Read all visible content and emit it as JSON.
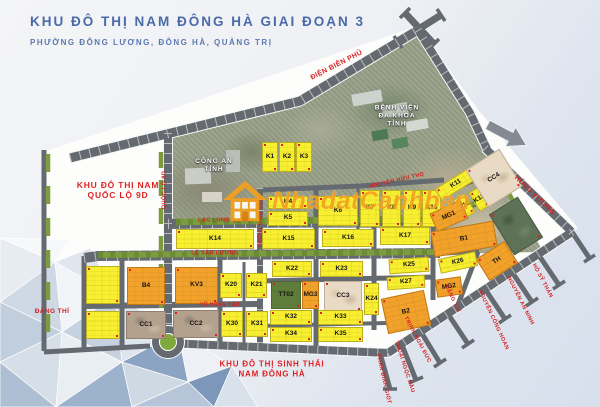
{
  "header": {
    "title": "KHU ĐÔ THỊ NAM ĐÔNG HÀ GIAI ĐOẠN 3",
    "subtitle": "PHƯỜNG ĐÔNG LƯƠNG, ĐÔNG HÀ, QUẢNG TRỊ"
  },
  "watermark": {
    "text": "NhadatCanhban"
  },
  "adjacent_areas": {
    "nam_ql9d": {
      "line1": "KHU ĐÔ THỊ NAM",
      "line2": "QUỐC LỘ 9D"
    },
    "sinh_thai": {
      "line1": "KHU ĐÔ THỊ SINH THÁI",
      "line2": "NAM ĐÔNG HÀ"
    }
  },
  "landmarks": {
    "cong_an": {
      "line1": "CÔNG AN",
      "line2": "TỈNH"
    },
    "benh_vien": {
      "line1": "BỆNH VIỆN",
      "line2": "ĐA KHOA",
      "line3": "TỈNH"
    }
  },
  "streets": {
    "dien_bien_phu": "ĐIỆN BIÊN PHỦ",
    "hung_vuong": "HÙNG VƯƠNG",
    "quoc_lo_9d": "QUỐC LỘ 9D",
    "lac_long_quan": "LẠC LONG QUÂN",
    "le_van_luong": "LÊ VĂN LƯƠNG",
    "tran_binh_trong": "TRẦN BÌNH TRỌNG",
    "nguyen_huu_tho": "NGUYỄN HỮU THỌ",
    "vu_hong_tan": "VŨ HỒNG TẤN",
    "dang_thi": "ĐẶNG THÍ",
    "phan_dinh_giot": "PHAN ĐÌNH GIÓT",
    "thoai_ngoc_hau": "THOẠI NGỌC HẦU",
    "trinh_hoai_duc": "TRỊNH HOÀI ĐỨC",
    "nguyen_cong_hoan": "NGUYỄN CÔNG HOAN",
    "nguyen_an_ninh": "NGUYỄN AN NINH",
    "ho_sy_than": "HỒ SỸ THẢN"
  },
  "blocks": {
    "k1": {
      "label": "K1"
    },
    "k2": {
      "label": "K2"
    },
    "k3": {
      "label": "K3"
    },
    "k4": {
      "label": "K4"
    },
    "k5": {
      "label": "K5"
    },
    "k6": {
      "label": "K6"
    },
    "k7": {
      "label": "K7"
    },
    "k8": {
      "label": "K8"
    },
    "k9": {
      "label": "K9"
    },
    "k10": {
      "label": "K10"
    },
    "k11": {
      "label": "K11"
    },
    "k12": {
      "label": "K12"
    },
    "k13": {
      "label": "K13"
    },
    "k14": {
      "label": "K14"
    },
    "k15": {
      "label": "K15"
    },
    "k16": {
      "label": "K16"
    },
    "k17": {
      "label": "K17"
    },
    "k20": {
      "label": "K20"
    },
    "k21": {
      "label": "K21"
    },
    "k22": {
      "label": "K22"
    },
    "k23": {
      "label": "K23"
    },
    "k24": {
      "label": "K24"
    },
    "k25": {
      "label": "K25"
    },
    "k26": {
      "label": "K26"
    },
    "k27": {
      "label": "K27"
    },
    "k30": {
      "label": "K30"
    },
    "k31": {
      "label": "K31"
    },
    "k32": {
      "label": "K32"
    },
    "k33": {
      "label": "K33"
    },
    "k34": {
      "label": "K34"
    },
    "k35": {
      "label": "K35"
    },
    "b1": {
      "label": "B1"
    },
    "b2": {
      "label": "B2"
    },
    "b4": {
      "label": "B4"
    },
    "kv3": {
      "label": "KV3"
    },
    "tt02": {
      "label": "TT02"
    },
    "th": {
      "label": "TH"
    },
    "mg1": {
      "label": "MG1"
    },
    "mg2": {
      "label": "MG2"
    },
    "mg3": {
      "label": "MG3"
    },
    "cc1": {
      "label": "CC1"
    },
    "cc2": {
      "label": "CC2"
    },
    "cc3": {
      "label": "CC3"
    },
    "cc4": {
      "label": "CC4"
    }
  },
  "colors": {
    "lot_yellow": "#f7ef2f",
    "lot_orange": "#f2a12b",
    "lot_green": "#5e7d3c",
    "lot_beige": "#e8dac4",
    "road_gray": "#656a70",
    "median_green": "#7c9c3e",
    "street_red": "#d42020",
    "title_blue": "#4a6aa8",
    "watermark_orange": "#f5a01e"
  }
}
